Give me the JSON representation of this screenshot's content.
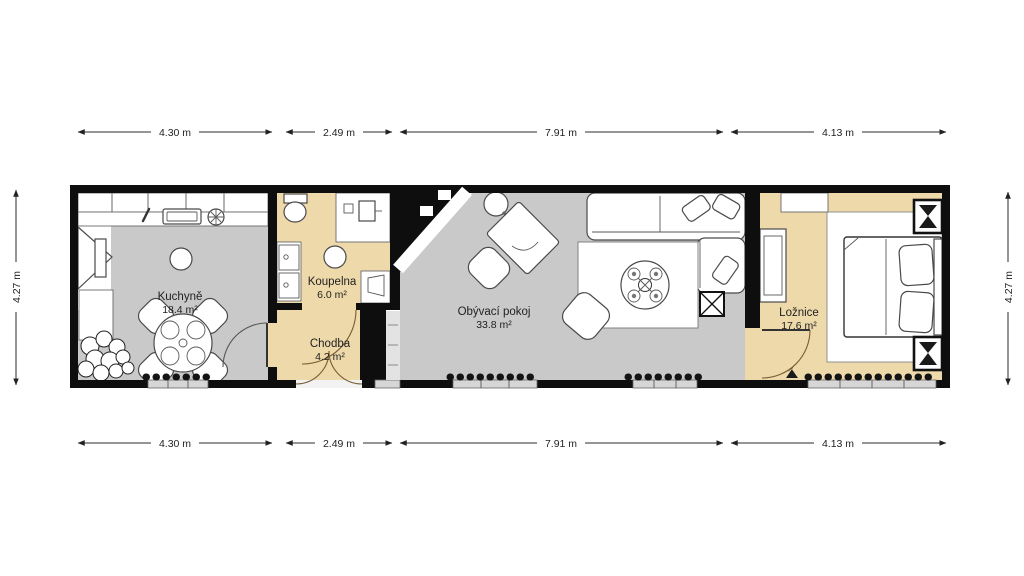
{
  "plan": {
    "title": "apartment-floor-plan",
    "colors": {
      "background": "#ffffff",
      "wall": "#0e0e0e",
      "floor_gray": "#c9c9c9",
      "floor_beige": "#eed9ab",
      "furniture": "#ffffff",
      "dimension_text": "#1f1f1f"
    },
    "rooms": [
      {
        "name": "Kuchyně",
        "area": "18.4 m²"
      },
      {
        "name": "Koupelna",
        "area": "6.0 m²"
      },
      {
        "name": "Chodba",
        "area": "4.2 m²"
      },
      {
        "name": "Obývací pokoj",
        "area": "33.8 m²"
      },
      {
        "name": "Ložnice",
        "area": "17.6 m²"
      }
    ],
    "dimensions": {
      "top": [
        "4.30 m",
        "2.49 m",
        "7.91 m",
        "4.13 m"
      ],
      "bottom": [
        "4.30 m",
        "2.49 m",
        "7.91 m",
        "4.13 m"
      ],
      "left": "4.27 m",
      "right": "4.27 m"
    }
  }
}
